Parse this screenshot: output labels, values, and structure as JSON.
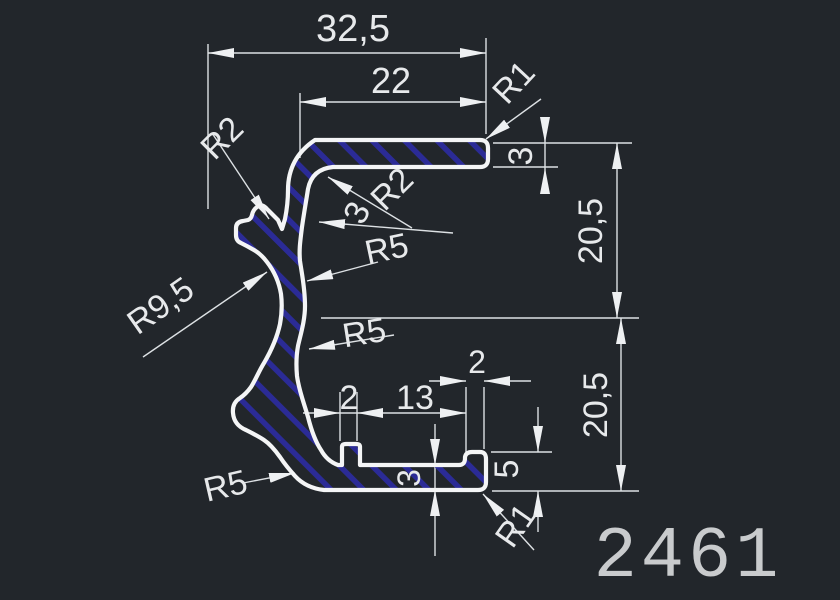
{
  "window": {
    "background": "#22262b"
  },
  "drawing": {
    "number": "2461",
    "profile_name": "extrusion-profile-cross-section",
    "colors": {
      "background": "#22262b",
      "outline": "#f4f5f6",
      "hatch_blue": "#2b2b96",
      "dimension_lines": "#dde1e4",
      "dimension_text": "#e7e9eb",
      "drawing_number_text": "#c9cbcd"
    },
    "dims": {
      "overall_width": "32,5",
      "top_width": "22",
      "top_right_radius": "R1",
      "top_flange_thickness": "3",
      "outer_corner_radius": "R2",
      "inner_corner_radius": "R2",
      "web_thickness": "3",
      "upper_web_radius": "R5",
      "left_recess_radius": "R9,5",
      "lower_web_radius": "R5",
      "upper_height": "20,5",
      "lower_height": "20,5",
      "rib_width": "2",
      "channel_width": "13",
      "lip_width": "2",
      "bottom_flange_thickness": "3",
      "lip_height": "5",
      "bottom_left_radius": "R5",
      "bottom_right_radius": "R1"
    }
  }
}
